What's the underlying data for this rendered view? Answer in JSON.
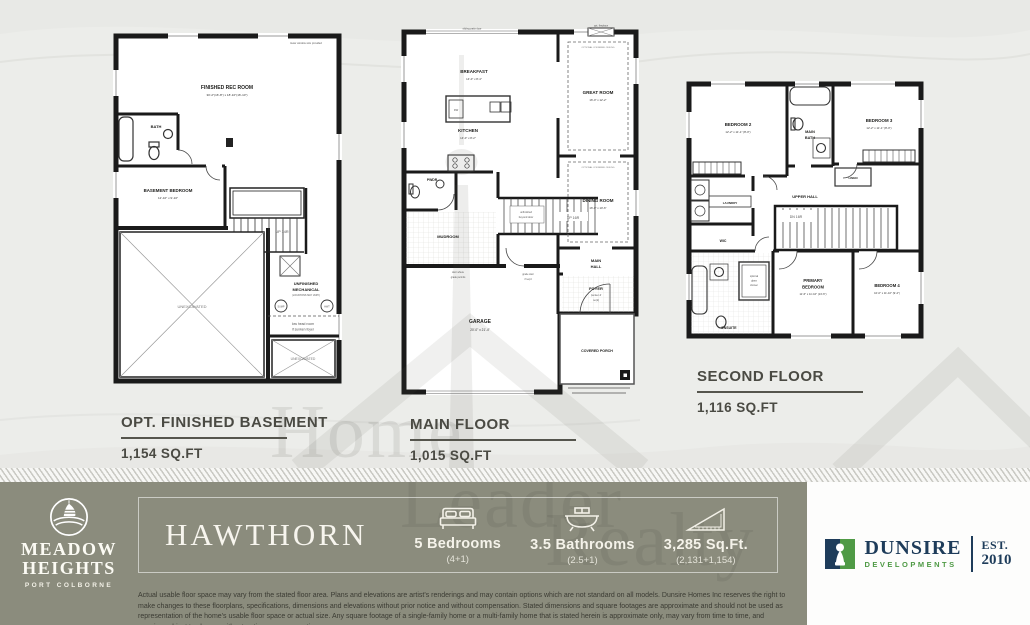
{
  "watermark": {
    "word1": "Home",
    "word2": "Leader",
    "word3": "Realty"
  },
  "plans": {
    "basement": {
      "title": "OPT. FINISHED BASEMENT",
      "sqft": "1,154 SQ.FT",
      "labels": {
        "note_window": "lower window size provided",
        "rec_name": "FINISHED REC ROOM",
        "rec_dims": "30'-2\"(16'-8\") x 18'-10\"(16'-10\")",
        "bath": "BATH",
        "bed_name": "BASEMENT BEDROOM",
        "bed_dims": "12'-10\" x 9'-10\"",
        "stairs": "UP 14R",
        "mech_1": "UNFINISHED",
        "mech_2": "MECHANICAL",
        "mech_note": "(LOCATIONS MAY VARY)",
        "sump": "SUMP",
        "hwt": "HWT",
        "lowhead_1": "low head room",
        "lowhead_2": "if sunken foyer",
        "unexcavated": "UNEXCAVATED"
      }
    },
    "main": {
      "title": "MAIN FLOOR",
      "sqft": "1,015 SQ.FT",
      "labels": {
        "patio": "sliding patio door",
        "fireplace": "opt. fireplace",
        "breakfast_name": "BREAKFAST",
        "breakfast_dims": "14'-0\" x 8'-4\"",
        "kitchen_name": "KITCHEN",
        "kitchen_dims": "14'-0\" x 8'-2\"",
        "dw": "DW",
        "great_name": "GREAT ROOM",
        "great_dims": "16'-0\" x 12'-2\"",
        "dining_name": "DINING ROOM",
        "dining_dims": "16'-0\" x 10'-6\"",
        "coffered": "OPTIONAL COFFERED CEILING",
        "pwdr": "PWDR",
        "mudroom": "MUDROOM",
        "stairs": "UP 16R",
        "stair_note_1": "unfinished",
        "stair_note_2": "beyond door",
        "hall_1": "MAIN",
        "hall_2": "HALL",
        "foyer": "FOYER",
        "foyer_note_1": "(sunken if",
        "foyer_note_2": "req'd)",
        "garage_name": "GARAGE",
        "garage_dims": "20'-0\" x 21'-4\"",
        "porch": "COVERED PORCH",
        "grade_door_1": "door where",
        "grade_door_2": "grade permits",
        "grade_stair_1": "grade stair",
        "grade_stair_2": "if req'd"
      }
    },
    "second": {
      "title": "SECOND FLOOR",
      "sqft": "1,116 SQ.FT",
      "labels": {
        "bed2_name": "BEDROOM 2",
        "bed2_dims": "12'-2\" x 11'-1\" (8'-0\")",
        "bed3_name": "BEDROOM 3",
        "bed3_dims": "12'-2\" x 11'-1\" (8'-0\")",
        "bath_1": "MAIN",
        "bath_2": "BATH",
        "linen": "LINEN",
        "hall": "UPPER HALL",
        "laundry": "LAUNDRY",
        "wic": "WIC",
        "stairs": "DN 16R",
        "ensuite": "ENSUITE",
        "shower_1": "optional",
        "shower_2": "glass",
        "shower_3": "shower",
        "primary_1": "PRIMARY",
        "primary_2": "BEDROOM",
        "primary_dims": "11'-6\" x 11'-10\" (13'-6\")",
        "bed4_name": "BEDROOM 4",
        "bed4_dims": "10'-0\" x 11'-10\" (9'-4\")"
      }
    }
  },
  "footer": {
    "community": {
      "name_line1": "MEADOW",
      "name_line2": "HEIGHTS",
      "subtitle": "PORT COLBORNE"
    },
    "plan_name": "HAWTHORN",
    "stats": [
      {
        "icon": "bed-icon",
        "value": "5 Bedrooms",
        "sub": "(4+1)"
      },
      {
        "icon": "bath-icon",
        "value": "3.5 Bathrooms",
        "sub": "(2.5+1)"
      },
      {
        "icon": "area-icon",
        "value": "3,285 Sq.Ft.",
        "sub": "(2,131+1,154)"
      }
    ],
    "disclaimer": "Actual usable floor space may vary from the stated floor area. Plans and elevations are artist's renderings and may contain options which are not standard on all models. Dunsire Homes Inc reserves the right to make changes to these floorplans, specifications, dimensions and elevations without prior notice and without compensation. Stated dimensions and square footages are approximate and should not be used as representation of the home's usable floor space or actual size. Any square footage of a single-family home or a multi-family home that is stated herein is approximate only, may vary from time to time, and remains subject to change without notice or compensation",
    "developer": {
      "name": "DUNSIRE",
      "type": "DEVELOPMENTS",
      "est": "EST.",
      "year": "2010"
    }
  },
  "colors": {
    "bar": "#8b8c7d",
    "navy": "#1e3c5a",
    "green": "#4f9a45",
    "ivory": "#f6f4ec",
    "wall": "#1a1a1a"
  }
}
